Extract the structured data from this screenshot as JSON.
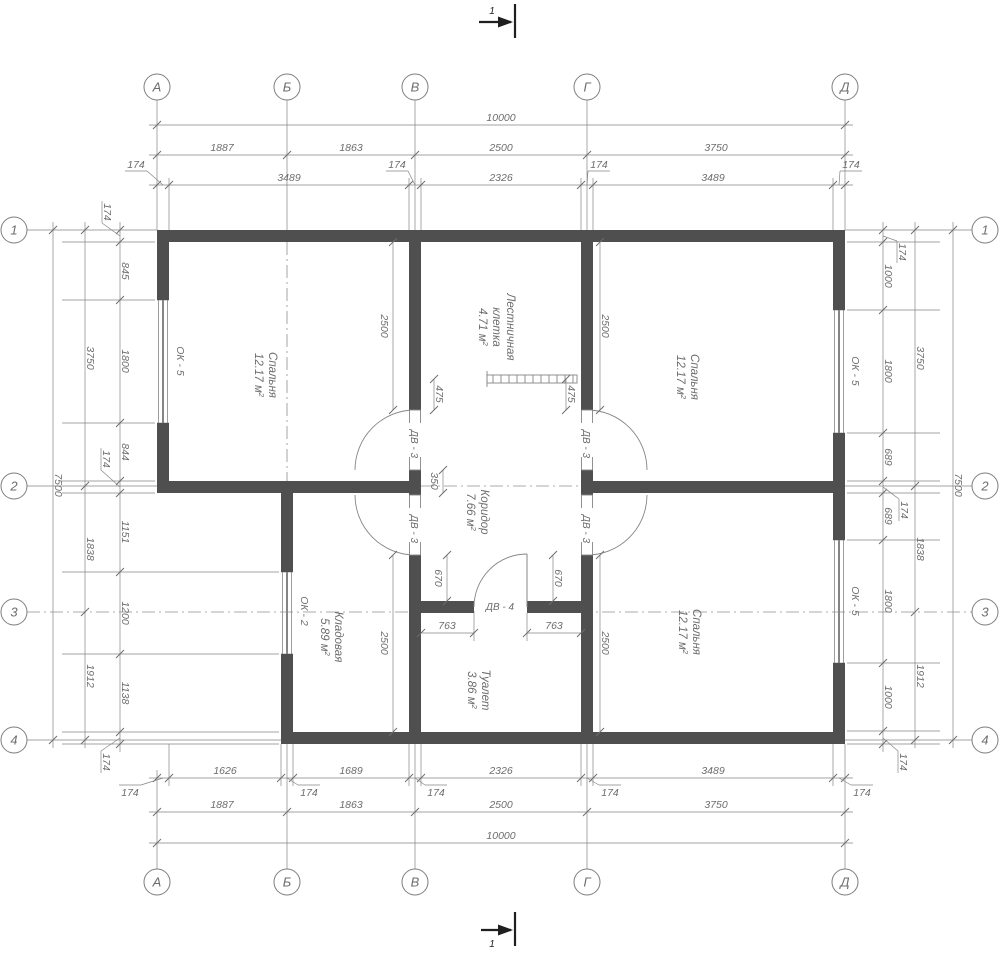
{
  "meta": {
    "type": "floor-plan",
    "width": 1000,
    "height": 955
  },
  "colors": {
    "bg": "#ffffff",
    "wall": "#4f4f4f",
    "line": "#858585",
    "dim_text": "#6d6d6d",
    "dash": "#909090",
    "dark": "#1f1f1f",
    "circle_stroke": "#7e7e7e"
  },
  "axis_circles": {
    "r": 13,
    "top": {
      "y": 87,
      "items": [
        {
          "label": "А",
          "x": 157
        },
        {
          "label": "Б",
          "x": 287
        },
        {
          "label": "В",
          "x": 415
        },
        {
          "label": "Г",
          "x": 587
        },
        {
          "label": "Д",
          "x": 845
        }
      ]
    },
    "bottom": {
      "y": 882,
      "items": [
        {
          "label": "А",
          "x": 157
        },
        {
          "label": "Б",
          "x": 287
        },
        {
          "label": "В",
          "x": 415
        },
        {
          "label": "Г",
          "x": 587
        },
        {
          "label": "Д",
          "x": 845
        }
      ]
    },
    "left": {
      "x": 14,
      "items": [
        {
          "label": "1",
          "y": 230
        },
        {
          "label": "2",
          "y": 486
        },
        {
          "label": "3",
          "y": 612
        },
        {
          "label": "4",
          "y": 740
        }
      ]
    },
    "right": {
      "x": 985,
      "items": [
        {
          "label": "1",
          "y": 230
        },
        {
          "label": "2",
          "y": 486
        },
        {
          "label": "3",
          "y": 612
        },
        {
          "label": "4",
          "y": 740
        }
      ]
    }
  },
  "section_marks": [
    {
      "label": "1",
      "line": [
        515,
        4,
        515,
        38
      ],
      "shaft": [
        479,
        22,
        511,
        22
      ],
      "head": [
        513,
        22,
        498,
        16.5,
        498,
        27.5
      ],
      "lx": 492,
      "ly": 14
    },
    {
      "label": "1",
      "line": [
        515,
        912,
        515,
        946
      ],
      "shaft": [
        481,
        930,
        511,
        930
      ],
      "head": [
        513,
        930,
        498,
        924.5,
        498,
        935.5
      ],
      "lx": 492,
      "ly": 947
    }
  ],
  "walls": [
    [
      157,
      230,
      688,
      12
    ],
    [
      157,
      242,
      12,
      58
    ],
    [
      157,
      423,
      12,
      70
    ],
    [
      157,
      481,
      264,
      12
    ],
    [
      581,
      481,
      264,
      12
    ],
    [
      281,
      493,
      12,
      79
    ],
    [
      281,
      654,
      12,
      90
    ],
    [
      281,
      732,
      564,
      12
    ],
    [
      409,
      242,
      12,
      168
    ],
    [
      409,
      470,
      12,
      25
    ],
    [
      409,
      555,
      12,
      189
    ],
    [
      581,
      242,
      12,
      168
    ],
    [
      581,
      470,
      12,
      25
    ],
    [
      581,
      555,
      12,
      189
    ],
    [
      833,
      242,
      12,
      68
    ],
    [
      833,
      433,
      12,
      107
    ],
    [
      833,
      663,
      12,
      81
    ],
    [
      421,
      601,
      53,
      12
    ],
    [
      527,
      601,
      54,
      12
    ]
  ],
  "windows": [
    {
      "label": "ОК - 5",
      "x": 157,
      "y": 300,
      "w": 12,
      "h": 123,
      "lx": 177,
      "ly": 361
    },
    {
      "label": "ОК - 5",
      "x": 833,
      "y": 310,
      "w": 12,
      "h": 123,
      "lx": 852,
      "ly": 371
    },
    {
      "label": "ОК - 5",
      "x": 833,
      "y": 540,
      "w": 12,
      "h": 123,
      "lx": 852,
      "ly": 601
    },
    {
      "label": "ОК - 2",
      "x": 281,
      "y": 572,
      "w": 12,
      "h": 82,
      "lx": 301,
      "ly": 611
    }
  ],
  "doors": [
    {
      "label": "ДВ - 3",
      "leaf": [
        409.5,
        410,
        11,
        60
      ],
      "arc": "M415,410 A60,60 0 0 0 355,470",
      "lx": 415,
      "ly": 440,
      "rot": true
    },
    {
      "label": "ДВ - 3",
      "leaf": [
        581.5,
        410,
        11,
        60
      ],
      "arc": "M587,410 A60,60 0 0 1 647,470",
      "lx": 587,
      "ly": 440,
      "rot": true
    },
    {
      "label": "ДВ - 3",
      "leaf": [
        409.5,
        495,
        11,
        60
      ],
      "arc": "M415,555 A60,60 0 0 1 355,495",
      "lx": 415,
      "ly": 525,
      "rot": true
    },
    {
      "label": "ДВ - 3",
      "leaf": [
        581.5,
        495,
        11,
        60
      ],
      "arc": "M587,555 A60,60 0 0 0 647,495",
      "lx": 587,
      "ly": 525,
      "rot": true
    },
    {
      "label": "ДВ - 4",
      "leaf_line": [
        527,
        554,
        527,
        607
      ],
      "arc": "M527,554 A53,53 0 0 0 474,607",
      "lx": 500,
      "ly": 610,
      "rot": false
    }
  ],
  "stairs": {
    "x": 487,
    "y": 375,
    "w": 90,
    "h": 8,
    "step": 8,
    "tick": [
      487,
      371,
      487,
      387
    ]
  },
  "rooms": [
    {
      "lines": [
        "Спальня"
      ],
      "area": "12.17",
      "unit": "м",
      "sup": "2",
      "cx": 266,
      "cy": 375
    },
    {
      "lines": [
        "Спальня"
      ],
      "area": "12.17",
      "unit": "м",
      "sup": "2",
      "cx": 688,
      "cy": 377
    },
    {
      "lines": [
        "Спальня"
      ],
      "area": "12.17",
      "unit": "м",
      "sup": "2",
      "cx": 690,
      "cy": 632
    },
    {
      "lines": [
        "Лестничная",
        "клетка"
      ],
      "area": "4.71",
      "unit": "м",
      "sup": "2",
      "cx": 497,
      "cy": 327
    },
    {
      "lines": [
        "Коридор"
      ],
      "area": "7.66",
      "unit": "м",
      "sup": "2",
      "cx": 478,
      "cy": 512
    },
    {
      "lines": [
        "Кладовая"
      ],
      "area": "5.89",
      "unit": "м",
      "sup": "2",
      "cx": 332,
      "cy": 637
    },
    {
      "lines": [
        "Туалет"
      ],
      "area": "3.86",
      "unit": "м",
      "sup": "2",
      "cx": 479,
      "cy": 690
    }
  ],
  "dash_lines": [
    [
      287,
      242,
      287,
      481
    ],
    [
      421,
      486,
      581,
      486
    ],
    [
      27,
      612,
      972,
      612
    ]
  ],
  "thin_lines": [
    [
      157,
      100,
      157,
      230
    ],
    [
      287,
      100,
      287,
      230
    ],
    [
      415,
      100,
      415,
      230
    ],
    [
      587,
      100,
      587,
      230
    ],
    [
      845,
      100,
      845,
      230
    ],
    [
      169,
      178,
      169,
      230
    ],
    [
      409,
      178,
      409,
      230
    ],
    [
      421,
      178,
      421,
      230
    ],
    [
      581,
      178,
      581,
      230
    ],
    [
      593,
      178,
      593,
      230
    ],
    [
      833,
      178,
      833,
      230
    ],
    [
      157,
      770,
      157,
      869
    ],
    [
      287,
      744,
      287,
      869
    ],
    [
      415,
      744,
      415,
      869
    ],
    [
      587,
      744,
      587,
      869
    ],
    [
      845,
      744,
      845,
      869
    ],
    [
      169,
      744,
      169,
      786
    ],
    [
      281,
      744,
      281,
      786
    ],
    [
      293,
      744,
      293,
      786
    ],
    [
      409,
      744,
      409,
      786
    ],
    [
      421,
      744,
      421,
      786
    ],
    [
      581,
      744,
      581,
      786
    ],
    [
      593,
      744,
      593,
      786
    ],
    [
      833,
      744,
      833,
      786
    ],
    [
      27,
      230,
      157,
      230
    ],
    [
      27,
      486,
      157,
      486
    ],
    [
      27,
      740,
      281,
      740
    ],
    [
      62,
      242,
      155,
      242
    ],
    [
      62,
      300,
      155,
      300
    ],
    [
      62,
      423,
      155,
      423
    ],
    [
      62,
      481,
      155,
      481
    ],
    [
      62,
      493,
      155,
      493
    ],
    [
      62,
      572,
      279,
      572
    ],
    [
      62,
      654,
      279,
      654
    ],
    [
      62,
      732,
      279,
      732
    ],
    [
      62,
      744,
      279,
      744
    ],
    [
      845,
      230,
      972,
      230
    ],
    [
      845,
      486,
      972,
      486
    ],
    [
      845,
      740,
      972,
      740
    ],
    [
      847,
      242,
      940,
      242
    ],
    [
      847,
      310,
      940,
      310
    ],
    [
      847,
      433,
      940,
      433
    ],
    [
      847,
      481,
      940,
      481
    ],
    [
      847,
      493,
      940,
      493
    ],
    [
      847,
      540,
      940,
      540
    ],
    [
      847,
      663,
      940,
      663
    ],
    [
      847,
      731,
      940,
      731
    ],
    [
      847,
      744,
      940,
      744
    ],
    [
      157,
      300,
      169,
      300
    ],
    [
      157,
      423,
      169,
      423
    ],
    [
      833,
      310,
      845,
      310
    ],
    [
      833,
      433,
      845,
      433
    ],
    [
      833,
      540,
      845,
      540
    ],
    [
      833,
      663,
      845,
      663
    ],
    [
      281,
      572,
      293,
      572
    ],
    [
      281,
      654,
      293,
      654
    ],
    [
      474,
      613,
      474,
      641
    ],
    [
      527,
      613,
      527,
      641
    ]
  ],
  "chains": [
    {
      "dir": "h",
      "pos": 185,
      "a1": 149,
      "a2": 853,
      "ticks": [
        157,
        169,
        409,
        421,
        581,
        593,
        833,
        845
      ],
      "labels": [
        {
          "v": "3489",
          "at": 289
        },
        {
          "v": "2326",
          "at": 501
        },
        {
          "v": "3489",
          "at": 713
        }
      ],
      "leaders": [
        {
          "v": "174",
          "p": 163,
          "lx": 136,
          "ly": 168
        },
        {
          "v": "174",
          "p": 415,
          "lx": 397,
          "ly": 168
        },
        {
          "v": "174",
          "p": 587,
          "lx": 599,
          "ly": 168
        },
        {
          "v": "174",
          "p": 839,
          "lx": 851,
          "ly": 168
        }
      ],
      "lbelow": false
    },
    {
      "dir": "h",
      "pos": 155,
      "a1": 149,
      "a2": 853,
      "ticks": [
        157,
        287,
        415,
        587,
        845
      ],
      "labels": [
        {
          "v": "1887",
          "at": 222
        },
        {
          "v": "1863",
          "at": 351
        },
        {
          "v": "2500",
          "at": 501
        },
        {
          "v": "3750",
          "at": 716
        }
      ]
    },
    {
      "dir": "h",
      "pos": 125,
      "a1": 149,
      "a2": 853,
      "ticks": [
        157,
        845
      ],
      "labels": [
        {
          "v": "10000",
          "at": 501
        }
      ]
    },
    {
      "dir": "h",
      "pos": 778,
      "a1": 149,
      "a2": 853,
      "ticks": [
        157,
        169,
        281,
        293,
        409,
        421,
        581,
        593,
        833,
        845
      ],
      "labels": [
        {
          "v": "1626",
          "at": 225
        },
        {
          "v": "1689",
          "at": 351
        },
        {
          "v": "2326",
          "at": 501
        },
        {
          "v": "3489",
          "at": 713
        }
      ],
      "leaders": [
        {
          "v": "174",
          "p": 163,
          "lx": 130,
          "ly": 796
        },
        {
          "v": "174",
          "p": 287,
          "lx": 309,
          "ly": 796
        },
        {
          "v": "174",
          "p": 415,
          "lx": 436,
          "ly": 796
        },
        {
          "v": "174",
          "p": 587,
          "lx": 610,
          "ly": 796
        },
        {
          "v": "174",
          "p": 839,
          "lx": 862,
          "ly": 796
        }
      ],
      "lbelow": true
    },
    {
      "dir": "h",
      "pos": 812,
      "a1": 149,
      "a2": 853,
      "ticks": [
        157,
        287,
        415,
        587,
        845
      ],
      "labels": [
        {
          "v": "1887",
          "at": 222
        },
        {
          "v": "1863",
          "at": 351
        },
        {
          "v": "2500",
          "at": 501
        },
        {
          "v": "3750",
          "at": 716
        }
      ]
    },
    {
      "dir": "h",
      "pos": 843,
      "a1": 149,
      "a2": 853,
      "ticks": [
        157,
        845
      ],
      "labels": [
        {
          "v": "10000",
          "at": 501
        }
      ]
    },
    {
      "dir": "v",
      "pos": 120,
      "a1": 222,
      "a2": 752,
      "ticks": [
        230,
        242,
        300,
        423,
        481,
        493,
        572,
        654,
        732,
        744
      ],
      "labels": [
        {
          "v": "845",
          "at": 271
        },
        {
          "v": "1800",
          "at": 361
        },
        {
          "v": "844",
          "at": 452
        },
        {
          "v": "1151",
          "at": 532
        },
        {
          "v": "1200",
          "at": 613
        },
        {
          "v": "1138",
          "at": 693
        }
      ],
      "leaders": [
        {
          "v": "174",
          "p": 236,
          "lx": 104,
          "ly": 212
        },
        {
          "v": "174",
          "p": 487,
          "lx": 103,
          "ly": 459
        },
        {
          "v": "174",
          "p": 738,
          "lx": 103,
          "ly": 762
        }
      ]
    },
    {
      "dir": "v",
      "pos": 85,
      "a1": 222,
      "a2": 748,
      "ticks": [
        230,
        486,
        612,
        740
      ],
      "labels": [
        {
          "v": "3750",
          "at": 358
        },
        {
          "v": "1838",
          "at": 549
        },
        {
          "v": "1912",
          "at": 676
        }
      ]
    },
    {
      "dir": "v",
      "pos": 53,
      "a1": 222,
      "a2": 748,
      "ticks": [
        230,
        740
      ],
      "labels": [
        {
          "v": "7500",
          "at": 485
        }
      ]
    },
    {
      "dir": "v",
      "pos": 883,
      "a1": 222,
      "a2": 752,
      "ticks": [
        230,
        242,
        310,
        433,
        481,
        493,
        540,
        663,
        731,
        744
      ],
      "labels": [
        {
          "v": "1000",
          "at": 276
        },
        {
          "v": "1800",
          "at": 371
        },
        {
          "v": "689",
          "at": 457
        },
        {
          "v": "689",
          "at": 516
        },
        {
          "v": "1800",
          "at": 601
        },
        {
          "v": "1000",
          "at": 697
        }
      ],
      "leaders": [
        {
          "v": "174",
          "p": 236,
          "lx": 899,
          "ly": 252
        },
        {
          "v": "174",
          "p": 487,
          "lx": 901,
          "ly": 510
        },
        {
          "v": "174",
          "p": 738,
          "lx": 900,
          "ly": 762
        }
      ]
    },
    {
      "dir": "v",
      "pos": 915,
      "a1": 222,
      "a2": 748,
      "ticks": [
        230,
        486,
        612,
        740
      ],
      "labels": [
        {
          "v": "3750",
          "at": 358
        },
        {
          "v": "1838",
          "at": 549
        },
        {
          "v": "1912",
          "at": 676
        }
      ]
    },
    {
      "dir": "v",
      "pos": 953,
      "a1": 222,
      "a2": 748,
      "ticks": [
        230,
        740
      ],
      "labels": [
        {
          "v": "7500",
          "at": 485
        }
      ]
    }
  ],
  "interior_dims": [
    {
      "dir": "v",
      "pos": 393,
      "a1": 242,
      "a2": 410,
      "v": "2500",
      "at": 326,
      "o": -12
    },
    {
      "dir": "v",
      "pos": 600,
      "a1": 242,
      "a2": 410,
      "v": "2500",
      "at": 326,
      "o": 2
    },
    {
      "dir": "v",
      "pos": 434,
      "a1": 379,
      "a2": 410,
      "v": "475",
      "at": 394,
      "o": 2
    },
    {
      "dir": "v",
      "pos": 566,
      "a1": 379,
      "a2": 410,
      "v": "475",
      "at": 394,
      "o": 2
    },
    {
      "dir": "v",
      "pos": 443,
      "a1": 470,
      "a2": 493,
      "v": "350",
      "at": 481,
      "o": -12
    },
    {
      "dir": "v",
      "pos": 447,
      "a1": 555,
      "a2": 601,
      "v": "670",
      "at": 578,
      "o": -12
    },
    {
      "dir": "v",
      "pos": 553,
      "a1": 555,
      "a2": 601,
      "v": "670",
      "at": 578,
      "o": 2
    },
    {
      "dir": "v",
      "pos": 393,
      "a1": 555,
      "a2": 732,
      "v": "2500",
      "at": 643,
      "o": -12
    },
    {
      "dir": "v",
      "pos": 600,
      "a1": 555,
      "a2": 732,
      "v": "2500",
      "at": 643,
      "o": 2
    },
    {
      "dir": "h",
      "pos": 633,
      "a1": 421,
      "a2": 474,
      "v": "763",
      "at": 447
    },
    {
      "dir": "h",
      "pos": 633,
      "a1": 527,
      "a2": 581,
      "v": "763",
      "at": 554
    }
  ]
}
